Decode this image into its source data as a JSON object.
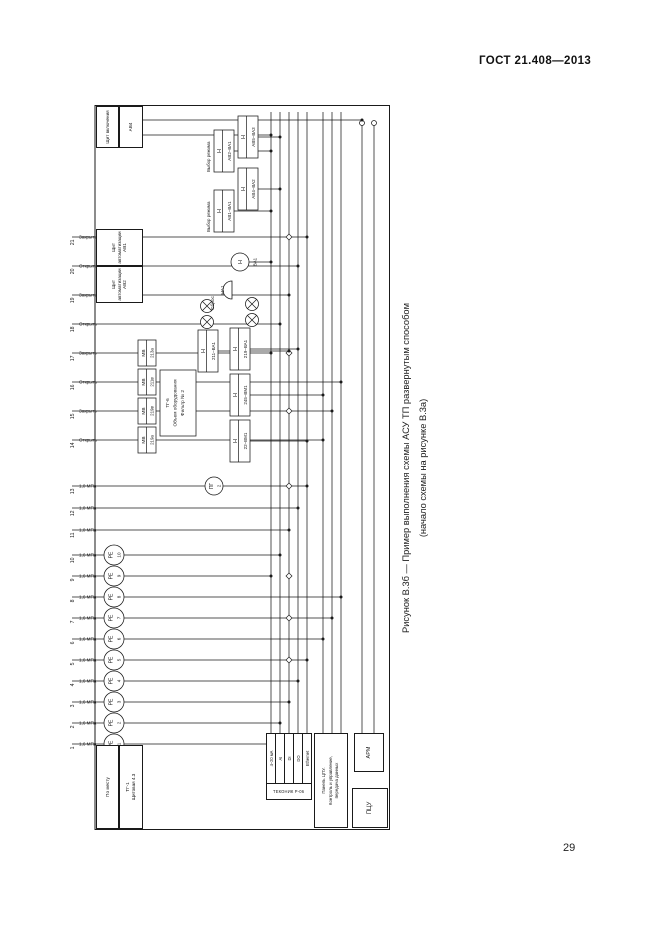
{
  "page": {
    "header": "ГОСТ 21.408—2013",
    "page_number": "29"
  },
  "caption": {
    "line1": "Рисунок В.3б — Пример выполнения схемы АСУ ТП развернутым способом",
    "line2": "(начало схемы на рисунке В.3а)"
  },
  "diagram": {
    "zones": [
      {
        "label": "По месту"
      },
      {
        "label": "ТГ-1",
        "sub": "Щитовая 4.3"
      },
      {
        "label": "Щит автоматизации АВ2"
      },
      {
        "label": "Щит автоматизации АВ1"
      },
      {
        "label": "Щит включения"
      },
      {
        "label": "АВ4"
      }
    ],
    "wires": [
      {
        "n": "1",
        "label": "1,6 МПа",
        "sensor": [
          "PE",
          "1"
        ]
      },
      {
        "n": "2",
        "label": "1,6 МПа",
        "sensor": [
          "PE",
          "2"
        ]
      },
      {
        "n": "3",
        "label": "1,6 МПа",
        "sensor": [
          "PE",
          "3"
        ]
      },
      {
        "n": "4",
        "label": "1,6 МПа",
        "sensor": [
          "PE",
          "4"
        ]
      },
      {
        "n": "5",
        "label": "1,6 МПа",
        "sensor": [
          "PE",
          "5"
        ]
      },
      {
        "n": "6",
        "label": "1,6 МПа",
        "sensor": [
          "PE",
          "6"
        ]
      },
      {
        "n": "7",
        "label": "1,6 МПа",
        "sensor": [
          "PE",
          "7"
        ]
      },
      {
        "n": "8",
        "label": "1,6 МПа",
        "sensor": [
          "PE",
          "8"
        ]
      },
      {
        "n": "9",
        "label": "1,6 МПа",
        "sensor": [
          "PE",
          "9"
        ]
      },
      {
        "n": "10",
        "label": "1,6 МПа",
        "sensor": [
          "PE",
          "10"
        ]
      },
      {
        "n": "11",
        "label": "1,0 МПа"
      },
      {
        "n": "12",
        "label": "1,0 МПа"
      },
      {
        "n": "13",
        "label": "1,0 МПа"
      },
      {
        "n": "14",
        "label": "Открыть"
      },
      {
        "n": "15",
        "label": "Закрыть"
      },
      {
        "n": "16",
        "label": "Открыть"
      },
      {
        "n": "17",
        "label": "Закрыть"
      },
      {
        "n": "18",
        "label": "Открыть"
      },
      {
        "n": "19",
        "label": "Закрыть"
      },
      {
        "n": "20",
        "label": "Открыть"
      },
      {
        "n": "21",
        "label": "Закрыть"
      }
    ],
    "mv_boxes": [
      {
        "rows": [
          "МВ",
          "219а"
        ]
      },
      {
        "rows": [
          "МВ",
          "219в"
        ]
      },
      {
        "rows": [
          "МВ",
          "211в"
        ]
      },
      {
        "rows": [
          "МВ",
          "213а"
        ]
      }
    ],
    "note": {
      "lines": [
        "ТГ-6",
        "Объем оборудования",
        "Фильтр № 2"
      ]
    },
    "h_boxes": [
      {
        "letter": "Н",
        "tag": "211–ВА1"
      },
      {
        "letter": "Н",
        "tag": "22–ВМ1"
      },
      {
        "letter": "Н",
        "tag": "245–ВМ1"
      },
      {
        "letter": "Н",
        "tag": "219–ВА1"
      },
      {
        "letter": "Н",
        "tag": "АВ1–ВА1"
      },
      {
        "letter": "Н",
        "tag": "АВ4–ВА2"
      },
      {
        "letter": "Н",
        "tag": "АВ2–ВА1"
      },
      {
        "letter": "Н",
        "tag": "АВ5–ВА3"
      }
    ],
    "mode_labels": [
      "Выбор режима",
      "Выбор режима"
    ],
    "bell": {
      "tag": "НА1"
    },
    "lamp_circle": {
      "letter": "Н",
      "tag": "ВА1"
    },
    "reset_label": "Сброс",
    "pg_circle": [
      "ПГ",
      "2"
    ],
    "controller": {
      "name": "ТЕКОНИК Р-06",
      "modules": [
        "4–20 мА",
        "AI",
        "DI",
        "DO",
        "Ethernet"
      ]
    },
    "panel": {
      "lines": [
        "Панель ЦПУ.",
        "Контроль и управление,",
        "передача данных"
      ]
    },
    "rooms": {
      "pcu": "ПЦУ",
      "arm": "АРМ"
    }
  }
}
